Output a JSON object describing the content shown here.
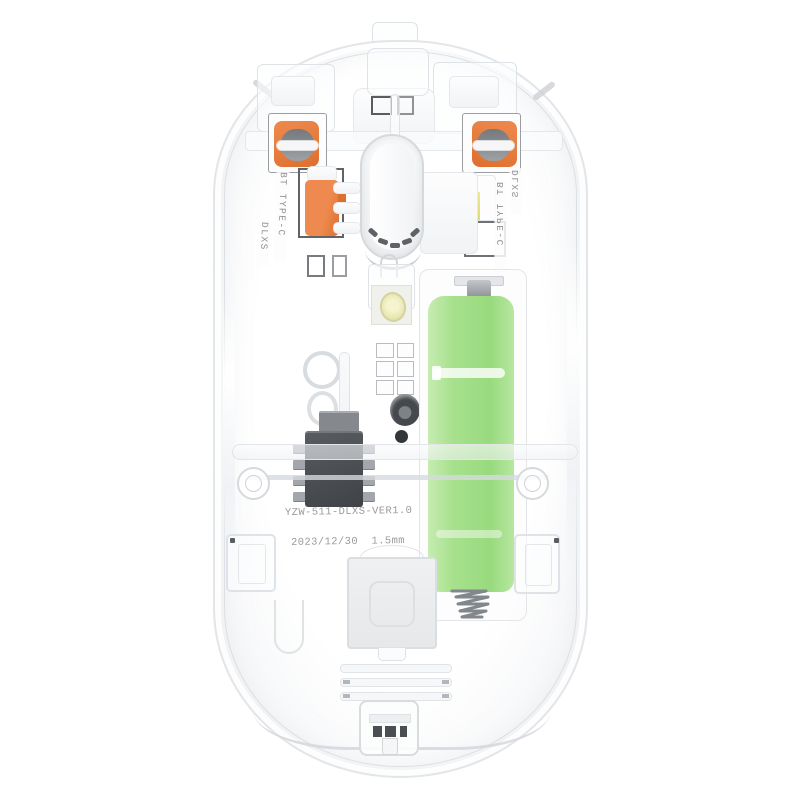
{
  "labels": {
    "left_port": "BT TYPE-C",
    "left_model": "DLXS",
    "right_model": "DLXS",
    "right_port": "BT TYPE-C",
    "pcb_model": "YZW-511-DLXS-VER1.0",
    "pcb_date": "2023/12/30",
    "pcb_thickness": "1.5mm"
  },
  "colors": {
    "battery_green": "#a8e18e",
    "battery_green_dark": "#98da7e",
    "battery_green_light": "#c6ecb2",
    "switch_orange": "#ee8a4f",
    "switch_orange_dark": "#dd6f2e",
    "led_yellow": "#dfdc6e",
    "led_lens_yellow": "#e9e7b0",
    "shell_line": "#dfe2e6",
    "text_gray": "#9b9b9b",
    "chip_dark": "#3f4347",
    "metal_gray": "#8d9195"
  }
}
